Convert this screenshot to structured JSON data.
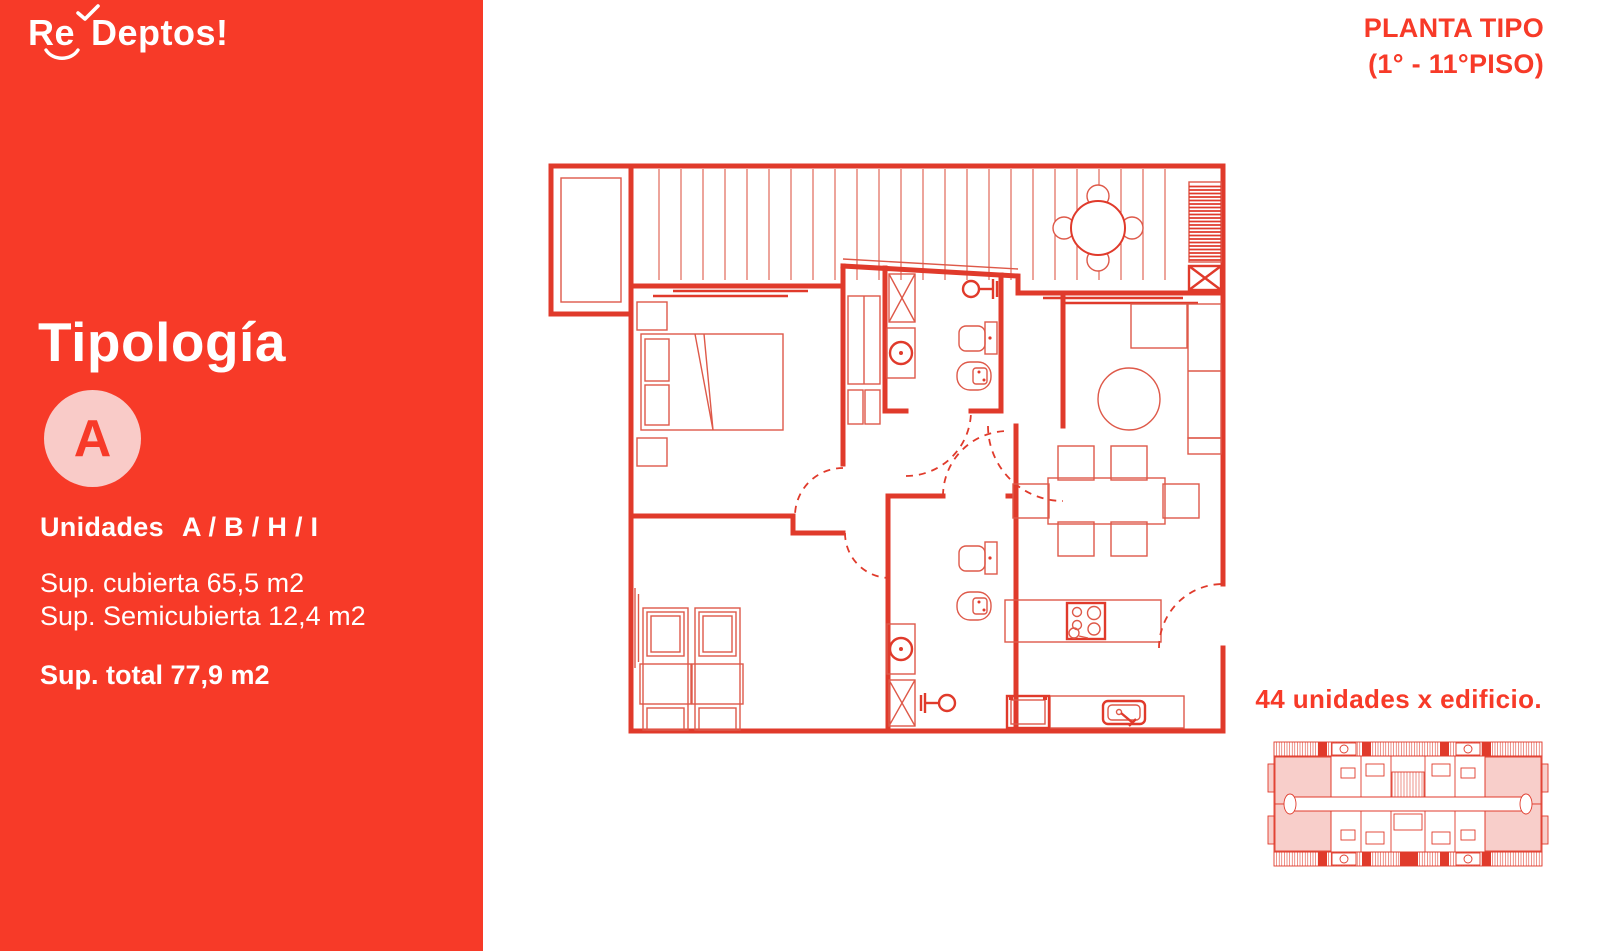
{
  "brand": {
    "logo_re": "Re",
    "logo_rest": "Deptos!",
    "check_icon": "check",
    "swash_icon": "swash"
  },
  "header": {
    "plan_type_line1": "PLANTA TIPO",
    "plan_type_line2": "(1° - 11°PISO)"
  },
  "sidebar": {
    "title": "Tipología",
    "type_badge": "A",
    "units_label": "Unidades",
    "units_value": "A / B / H / I",
    "sup_cubierta": "Sup. cubierta 65,5 m2",
    "sup_semicubierta": "Sup. Semicubierta 12,4 m2",
    "sup_total": "Sup. total 77,9 m2"
  },
  "footer": {
    "units_note": "44 unidades x edificio."
  },
  "colors": {
    "brand_red": "#f73a28",
    "plan_red": "#e03a2b",
    "thin_red": "#de5949",
    "badge_pink": "#f9cbc8",
    "unit_pink": "#f6beb8",
    "background": "#ffffff"
  }
}
